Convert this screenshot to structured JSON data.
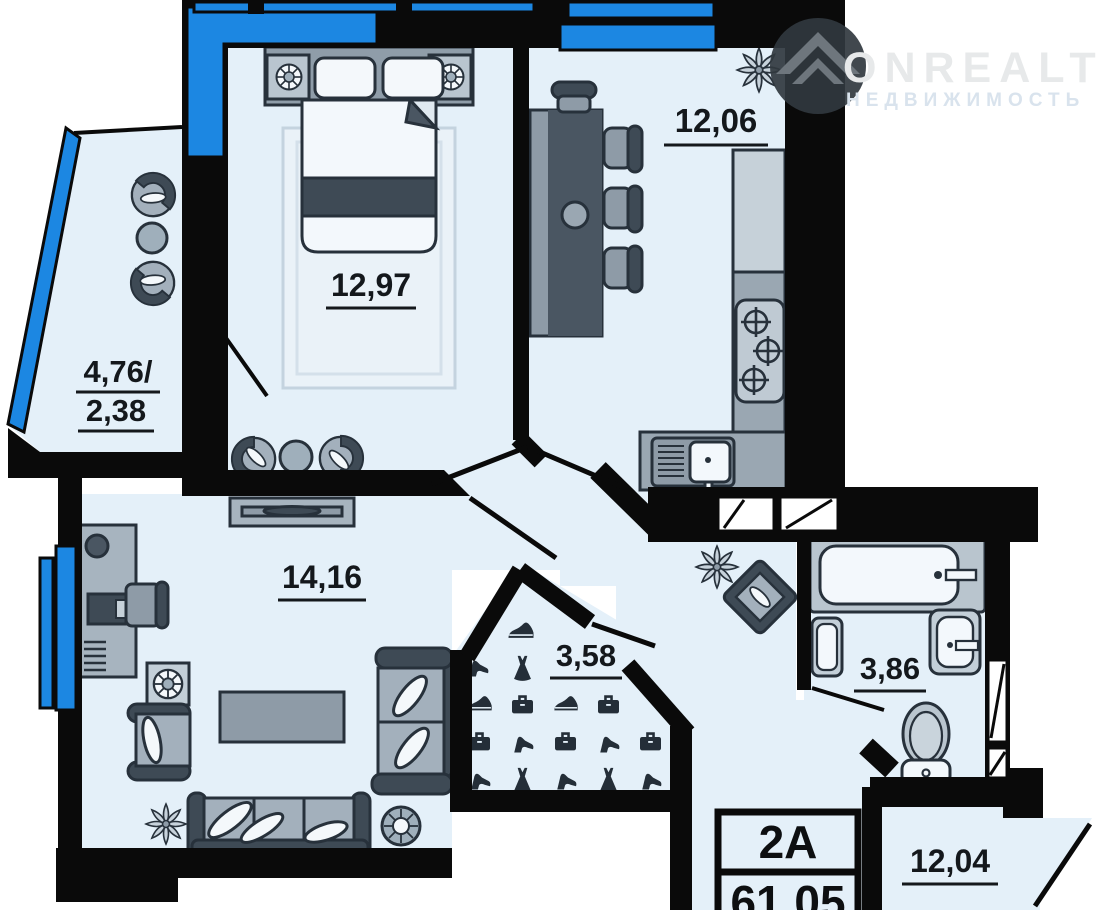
{
  "logo": {
    "brand": "ONREALT",
    "subtitle": "НЕДВИЖИМОСТЬ"
  },
  "plan": {
    "rooms": {
      "bedroom": {
        "area": "12,97"
      },
      "kitchen": {
        "area": "12,06"
      },
      "loggia": {
        "area_full": "4,76/",
        "area_half": "2,38"
      },
      "living": {
        "area": "14,16"
      },
      "wardrobe": {
        "area": "3,58"
      },
      "bathroom": {
        "area": "3,86"
      },
      "room2": {
        "area": "12,04"
      }
    },
    "unit": {
      "type": "2А",
      "total_area": "61,05"
    },
    "colors": {
      "window_blue": "#1c87e2",
      "wall_black": "#0a0a0a",
      "floor_light": "#e4f0f9",
      "furniture_gray": "#9fafbb",
      "furniture_dark": "#3e4a55"
    }
  }
}
